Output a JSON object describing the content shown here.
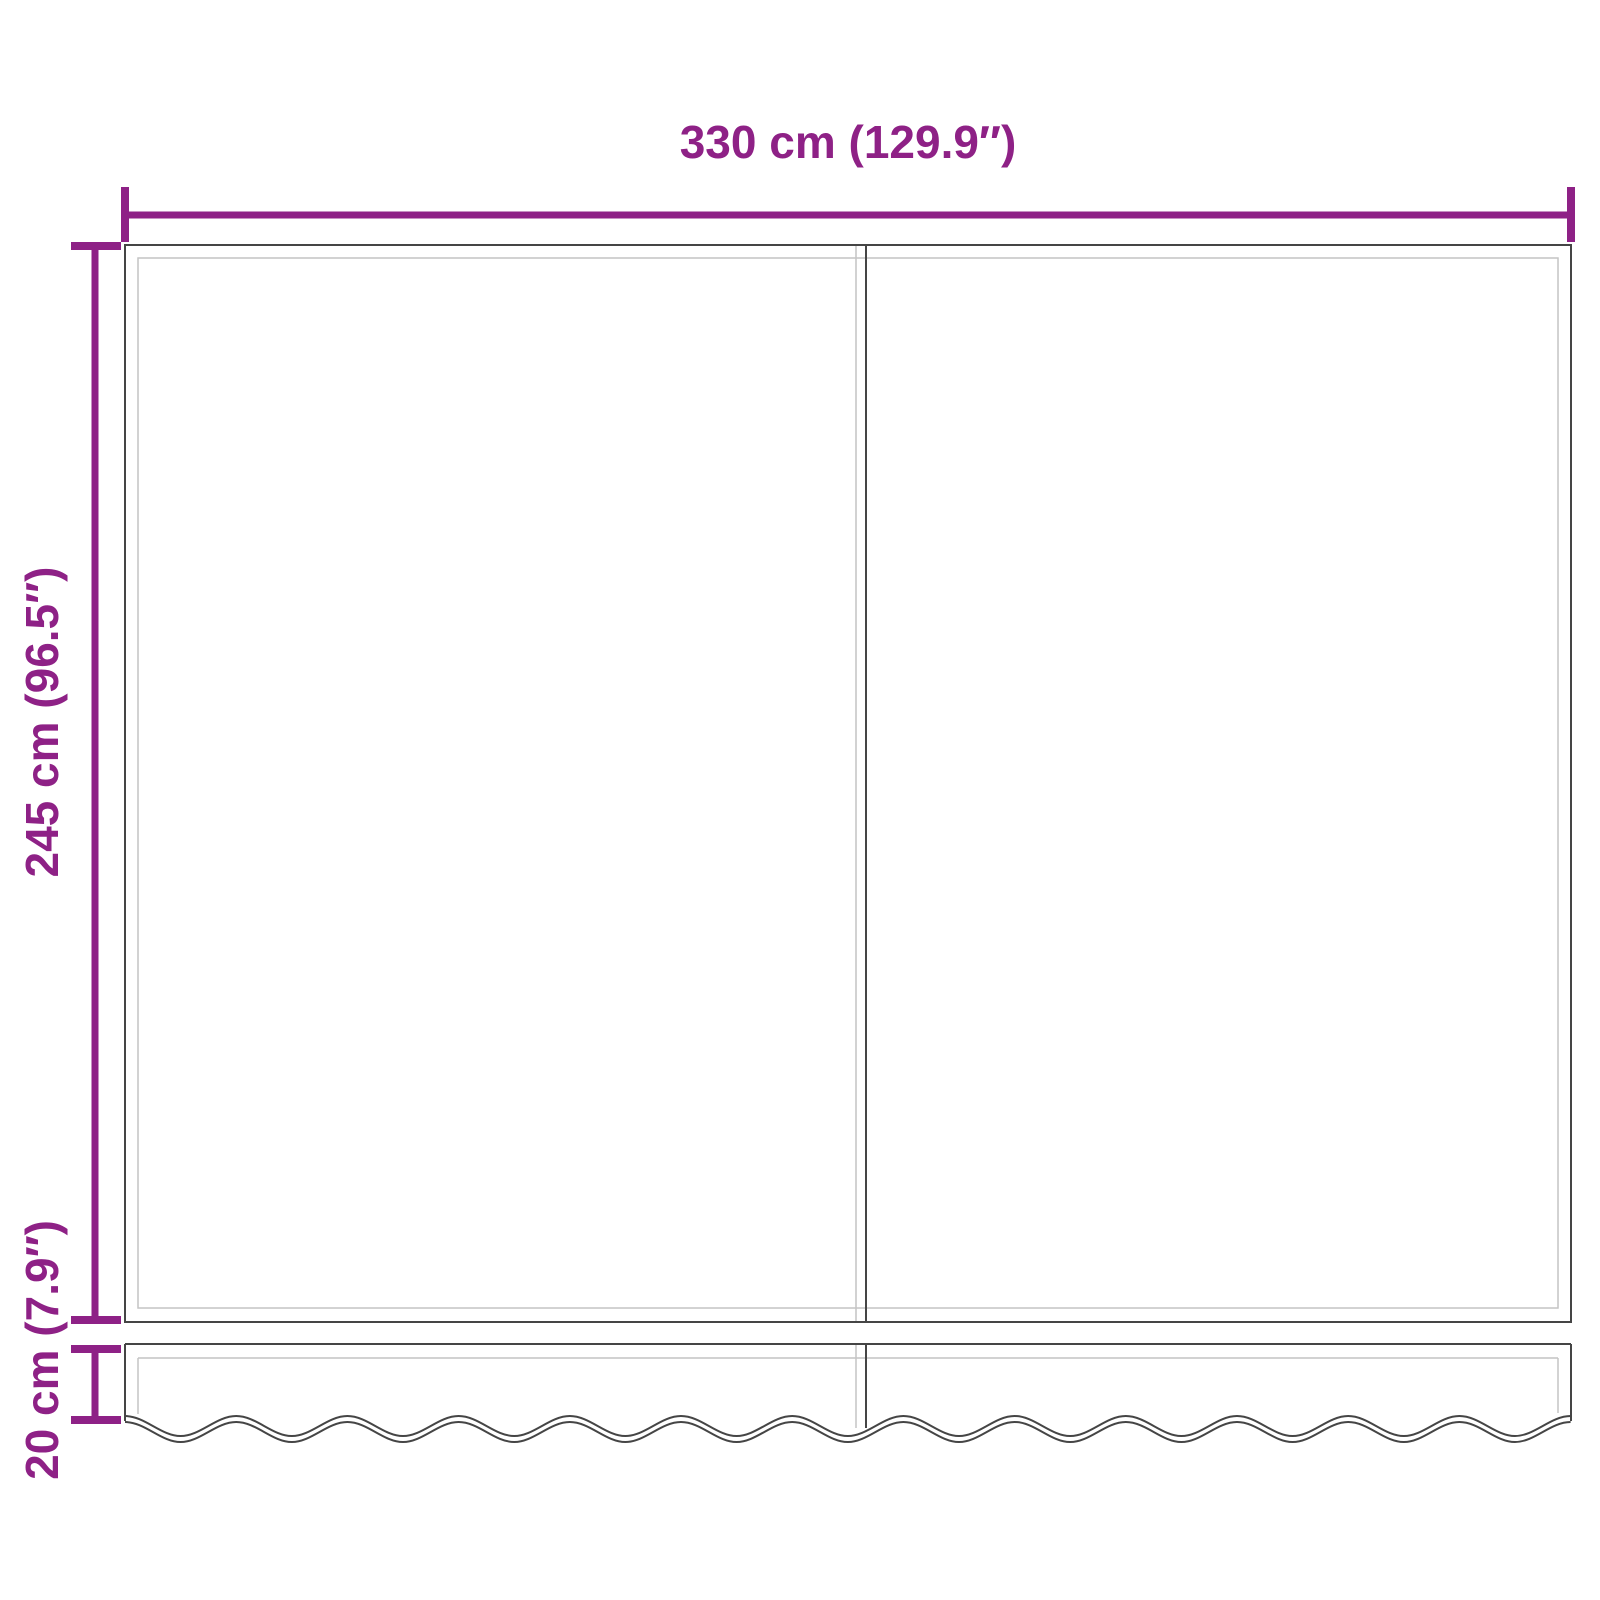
{
  "colors": {
    "dimension": "#8E2186",
    "outline-dark": "#454545",
    "outline-light": "#C4C4C4",
    "background": "#FFFFFF"
  },
  "dimensions": {
    "width": {
      "label": "330 cm (129.9″)"
    },
    "height": {
      "label": "245 cm (96.5″)"
    },
    "valance": {
      "label": "20 cm (7.9″)"
    }
  }
}
